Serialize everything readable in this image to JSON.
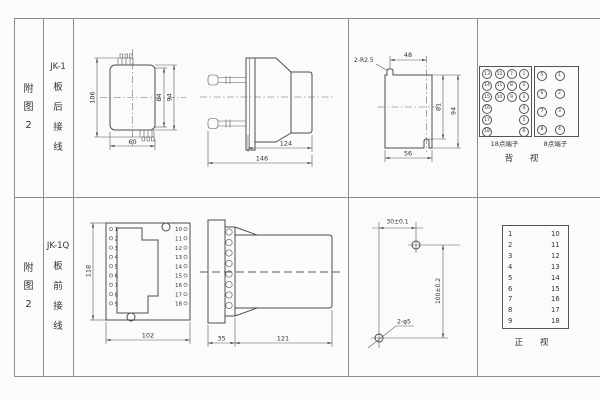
{
  "colors": {
    "line": "#4c4c4c",
    "border": "#8d8d8d",
    "background": "#fbfbfb",
    "text": "#333333"
  },
  "rows": [
    {
      "fig_chars": [
        "附",
        "图",
        "2"
      ],
      "model": "JK-1",
      "wiring_chars": [
        "板",
        "后",
        "接",
        "线"
      ],
      "front_view": {
        "dim_height": "106",
        "dim_inner": "84",
        "dim_mid": "94",
        "dim_width": "60"
      },
      "side_view": {
        "dim_body": "124",
        "dim_total": "146"
      },
      "cutout": {
        "label_radius": "2-R2.5",
        "dim_top": "48",
        "dim_inner_h": "81",
        "dim_full_h": "94",
        "dim_bottom": "56"
      },
      "rear_terminals": {
        "t18_label": "18点端子",
        "t8_label": "8点端子",
        "caption": "背 视",
        "t18_grid": [
          [
            "13",
            "12",
            "7",
            "1"
          ],
          [
            "14",
            "11",
            "8",
            "2"
          ],
          [
            "15",
            "10",
            "9",
            "3"
          ],
          [
            "16",
            "",
            "",
            "4"
          ],
          [
            "17",
            "",
            "",
            "5"
          ],
          [
            "18",
            "",
            "",
            "6"
          ]
        ],
        "t8_grid": [
          [
            "5",
            "1"
          ],
          [
            "6",
            "2"
          ],
          [
            "7",
            "3"
          ],
          [
            "8",
            "4"
          ]
        ]
      }
    },
    {
      "fig_chars": [
        "附",
        "图",
        "2"
      ],
      "model": "JK-1Q",
      "wiring_chars": [
        "板",
        "前",
        "接",
        "线"
      ],
      "front_view": {
        "dim_height": "118",
        "dim_width": "102",
        "left_terminals": [
          "1",
          "2",
          "3",
          "4",
          "5",
          "6",
          "7",
          "8",
          "9"
        ],
        "right_terminals": [
          "10",
          "11",
          "12",
          "13",
          "14",
          "15",
          "16",
          "17",
          "18"
        ]
      },
      "side_view": {
        "dim_flange": "35",
        "dim_body": "121"
      },
      "drill_plan": {
        "dim_top": "30±0.1",
        "dim_side": "100±0.2",
        "label_holes": "2-φ5"
      },
      "front_panel": {
        "left_terminals": [
          "1",
          "2",
          "3",
          "4",
          "5",
          "6",
          "7",
          "8",
          "9"
        ],
        "right_terminals": [
          "10",
          "11",
          "12",
          "13",
          "14",
          "15",
          "16",
          "17",
          "18"
        ],
        "caption": "正 视"
      }
    }
  ]
}
